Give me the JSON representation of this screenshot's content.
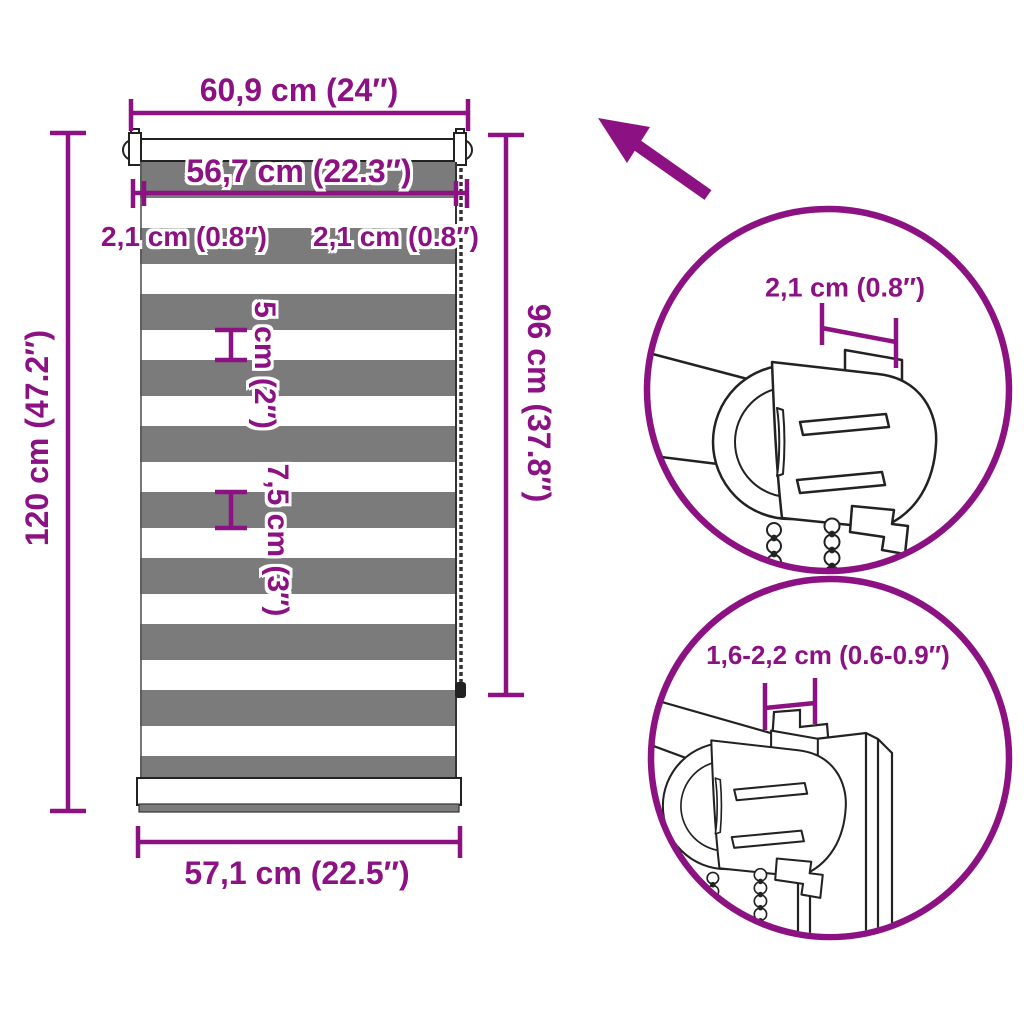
{
  "colors": {
    "accent_purple": "#8C1182",
    "stripe_gray": "#7B7B7B",
    "lineart_dark": "#222222",
    "background": "#FFFFFF"
  },
  "main_diagram": {
    "description": "zebra-roller-blind dimension drawing",
    "top_width_label": "60,9 cm (24″)",
    "fabric_width_label": "56,7 cm (22.3″)",
    "left_offset_label": "2,1 cm (0.8″)",
    "right_offset_label": "2,1 cm (0.8″)",
    "total_height_label": "120 cm (47.2″)",
    "fabric_height_label": "96 cm (37.8″)",
    "light_stripe_label": "5 cm (2″)",
    "dark_stripe_label": "7,5 cm (3″)",
    "bottom_width_label": "57,1 cm (22.5″)"
  },
  "detail_top_circle": {
    "description": "side bracket close-up",
    "bracket_depth_label": "2,1 cm (0.8″)"
  },
  "detail_bottom_circle": {
    "description": "clamp on window frame close-up",
    "frame_thickness_label": "1,6-2,2 cm (0.6-0.9″)"
  },
  "icons": {
    "arrow": "up-left-arrow"
  }
}
